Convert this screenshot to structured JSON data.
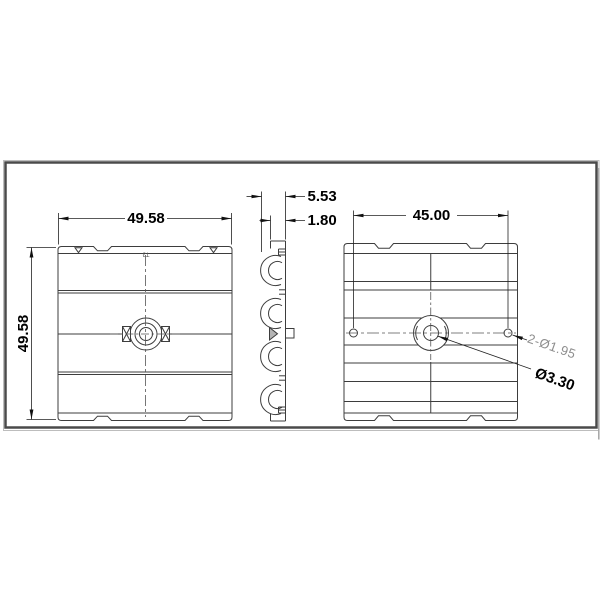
{
  "labels": {
    "front_width": "49.58",
    "front_height": "49.58",
    "profile_overall": "5.53",
    "profile_base": "1.80",
    "hole_pitch": "45.00",
    "side_holes": "2-Ø1.95",
    "center_hole": "Ø3.30",
    "mold_mark": "T3"
  },
  "colors": {
    "line": "#3d3d3d",
    "dimension": "#161616",
    "gray_label": "#8e8e8e",
    "frame": "#4a4a4a",
    "frame_shadow": "#a5a5a5",
    "background": "#ffffff"
  }
}
